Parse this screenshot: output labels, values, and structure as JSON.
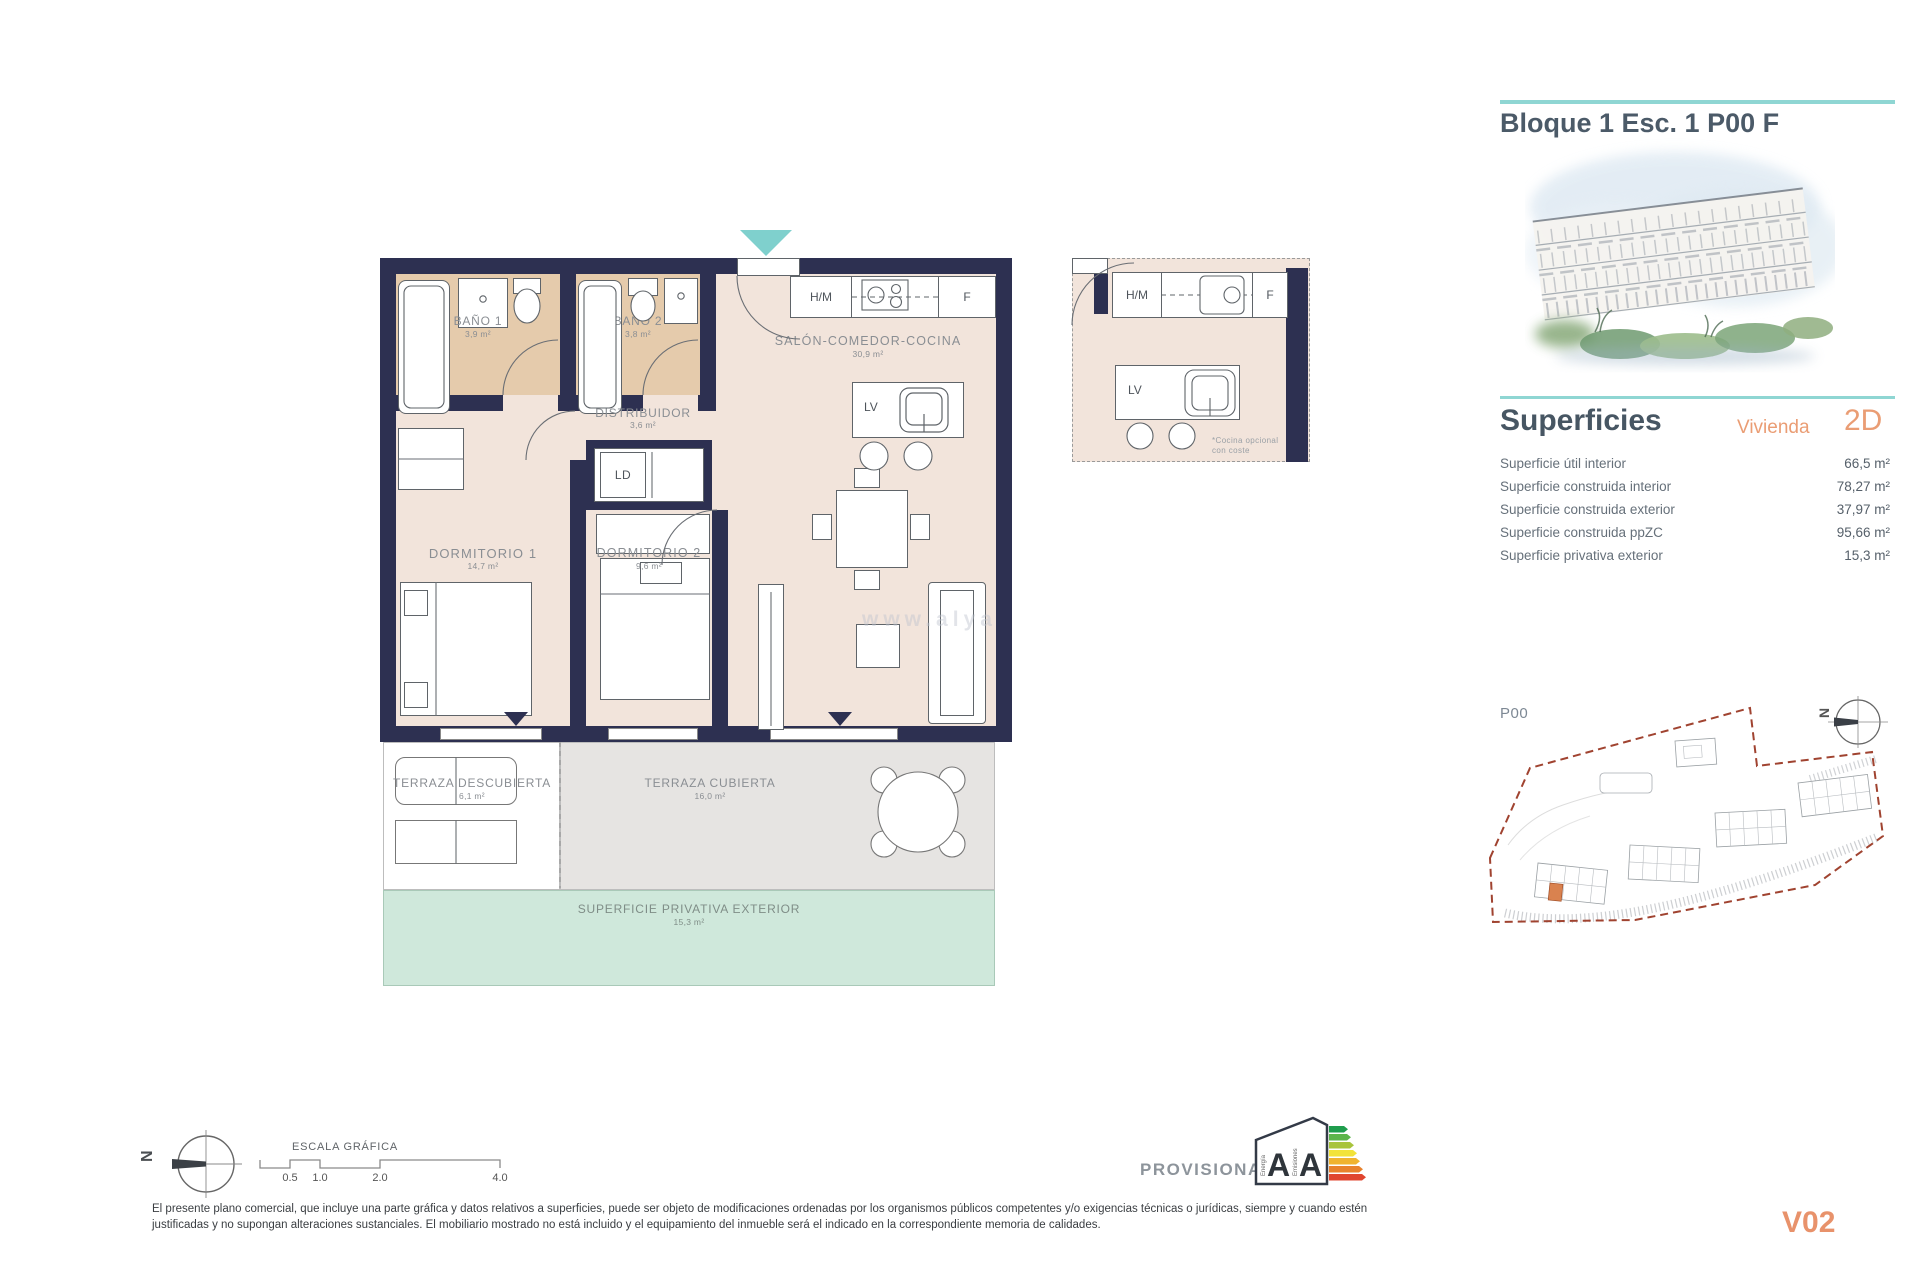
{
  "header": {
    "title": "Bloque 1 Esc. 1 P00 F"
  },
  "superficies": {
    "title": "Superficies",
    "vivienda_label": "Vivienda",
    "vivienda_code": "2D",
    "rows": [
      {
        "label": "Superficie útil interior",
        "value": "66,5 m²"
      },
      {
        "label": "Superficie construida interior",
        "value": "78,27 m²"
      },
      {
        "label": "Superficie construida exterior",
        "value": "37,97 m²"
      },
      {
        "label": "Superficie construida ppZC",
        "value": "95,66 m²"
      },
      {
        "label": "Superficie privativa exterior",
        "value": "15,3 m²"
      }
    ]
  },
  "floorplan": {
    "rooms": {
      "bano1": {
        "name": "BAÑO 1",
        "area": "3,9 m²"
      },
      "bano2": {
        "name": "BAÑO 2",
        "area": "3,8 m²"
      },
      "salon": {
        "name": "SALÓN-COMEDOR-COCINA",
        "area": "30,9 m²"
      },
      "distribuidor": {
        "name": "DISTRIBUIDOR",
        "area": "3,6 m²"
      },
      "dormitorio1": {
        "name": "DORMITORIO 1",
        "area": "14,7 m²"
      },
      "dormitorio2": {
        "name": "DORMITORIO 2",
        "area": "9,6 m²"
      },
      "terraza_descubierta": {
        "name": "TERRAZA DESCUBIERTA",
        "area": "6,1 m²"
      },
      "terraza_cubierta": {
        "name": "TERRAZA CUBIERTA",
        "area": "16,0 m²"
      },
      "superficie_privativa": {
        "name": "SUPERFICIE PRIVATIVA EXTERIOR",
        "area": "15,3 m²"
      }
    },
    "fixtures": {
      "ld": "LD",
      "lv": "LV",
      "hm": "H/M",
      "f": "F"
    },
    "detail_note_line1": "*Cocina opcional",
    "detail_note_line2": "con coste",
    "watermark": "www.alya"
  },
  "site_plan": {
    "label": "P00",
    "north_letter": "N"
  },
  "scale_bar": {
    "title": "ESCALA GRÁFICA",
    "ticks": [
      "0.5",
      "1.0",
      "2.0",
      "4.0"
    ],
    "north_letter": "N"
  },
  "energy_label": {
    "provisional": "PROVISIONAL",
    "energy_letter": "A",
    "emissions_letter": "A",
    "energy_text": "Energía",
    "emissions_text": "Emisiones"
  },
  "footer": {
    "disclaimer": "El presente plano comercial, que incluye una parte gráfica y datos relativos a superficies, puede ser objeto de modificaciones ordenadas por los organismos públicos competentes y/o exigencias técnicas o jurídicas, siempre y cuando estén justificadas y no supongan alteraciones sustanciales. El mobiliario mostrado no está incluido y el equipamiento del inmueble será el indicado en la correspondiente memoria de calidades.",
    "version": "V02"
  },
  "colors": {
    "navy": "#2d3051",
    "beige": "#f2e4db",
    "tan": "#e5cbac",
    "teal": "#8fd6d3",
    "orange": "#ea9d74",
    "green_band": "#cfe8db",
    "terrace_gray": "#e6e4e2",
    "site_boundary": "#a04330",
    "highlight_unit": "#d9824f"
  }
}
